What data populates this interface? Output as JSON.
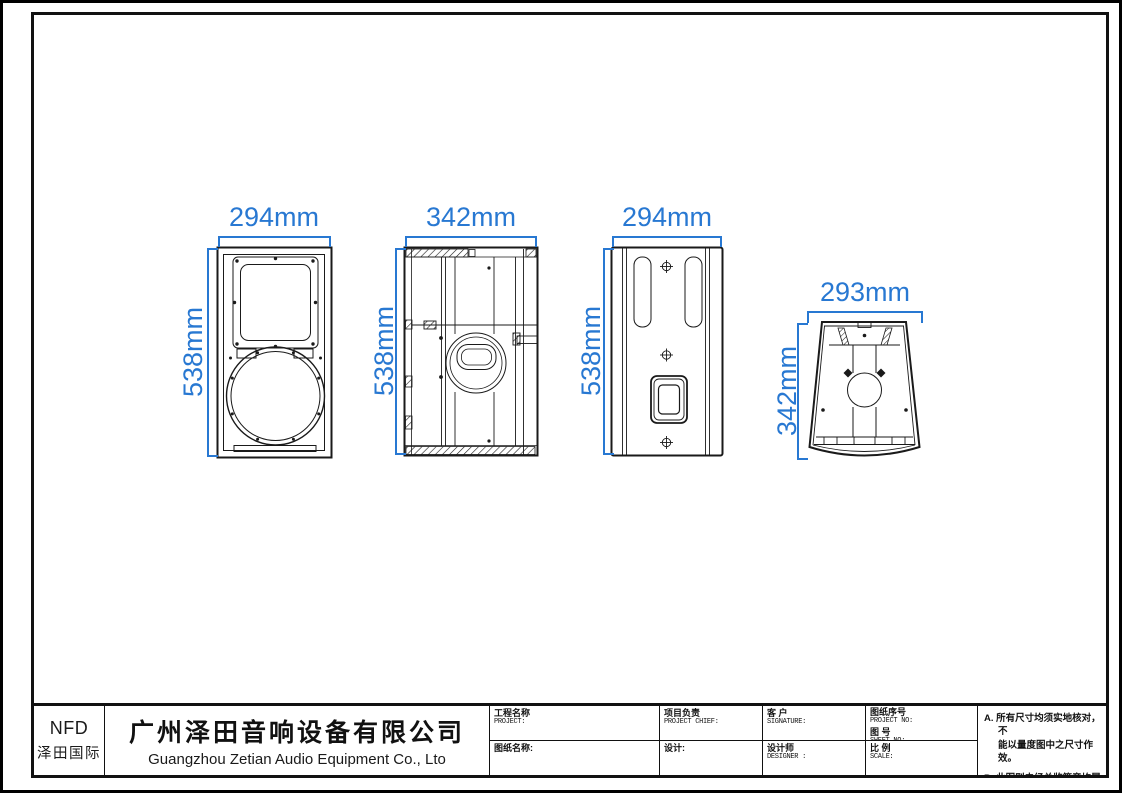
{
  "drawing": {
    "views": {
      "front": {
        "width": "294mm",
        "height": "538mm"
      },
      "side": {
        "width": "342mm",
        "height": "538mm"
      },
      "back": {
        "width": "294mm",
        "height": "538mm"
      },
      "top": {
        "width": "293mm",
        "height": "342mm"
      }
    }
  },
  "title_block": {
    "logo": {
      "brand": "NFD",
      "subtitle": "泽田国际"
    },
    "company": {
      "name_cn": "广州泽田音响设备有限公司",
      "name_en": "Guangzhou Zetian Audio Equipment Co., Lto"
    },
    "fields": {
      "project_cn": "工程名称",
      "project_en": "PROJECT:",
      "drawing_name": "图纸名称:",
      "chief_cn": "项目负责",
      "chief_en": "PROJECT CHIEF:",
      "design": "设计:",
      "client_cn": "客 户",
      "client_en": "SIGNATURE:",
      "designer_cn": "设计师",
      "designer_en": "DESIGNER :",
      "project_no_cn": "图纸序号",
      "project_no_en": "PROJECT NO:",
      "sheet_no_cn": "图 号",
      "sheet_no_en": "SHEET NO:",
      "scale_cn": "比 例",
      "scale_en": "SCALE:"
    },
    "notes": {
      "note_a": "A. 所有尺寸均须实地核对，不\n能以量度图中之尺寸作效。",
      "note_b": "B. 此图则未经总监签章均属无效。\n另作其它用途。"
    }
  },
  "colors": {
    "dimension_blue": "#2878D2",
    "line_black": "#1a1a1a"
  }
}
